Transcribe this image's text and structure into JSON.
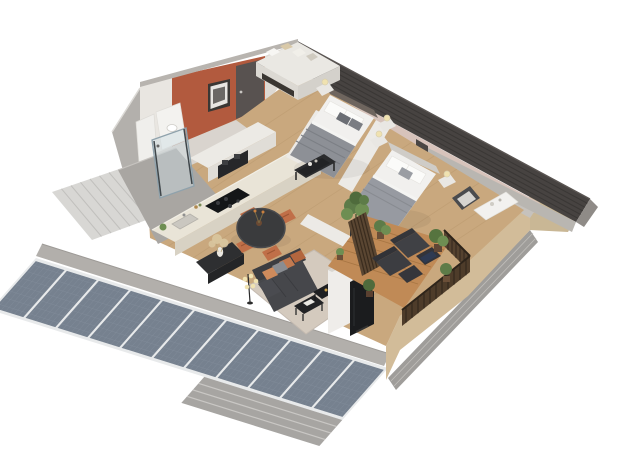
{
  "scene": {
    "kind": "3d-isometric-cutaway-floorplan-render",
    "description": "Attic apartment cutaway floor plan with rooftop solar array, two bedrooms, open kitchen-living-dining room, bathroom, walk-in closet and wood balcony",
    "background": "#ffffff"
  },
  "palette": {
    "bg": "#ffffff",
    "roof_shingle": "#474341",
    "roof_fascia": "#b9b6b1",
    "roof_endcap": "#8f8b87",
    "wall_pink": "#d7c3bb",
    "wall_cap": "#c6c2bd",
    "metal_roof": "#d8d7d4",
    "plate_grey": "#b2afab",
    "slope_grey": "#a9a6a2",
    "outer_slope": "#b3b0ac",
    "solar_panel": "#76818f",
    "solar_frame": "#e8eaeb",
    "eave_grey": "#a7a5a2",
    "eave_grey_2": "#9f9d9a",
    "exterior_beige": "#d2bc99",
    "corner_beige": "#c9b795",
    "wall_terracotta": "#b25a3e",
    "wall_white": "#e9e6e1",
    "wall_grey_right": "#ddd9d3",
    "door_brown": "#585250",
    "floor_wood": "#c9a87e",
    "floor_bath": "#d9d4ce",
    "counter_cream": "#e9e4d7",
    "counter_front": "#d8d2c4",
    "hob_black": "#141618",
    "cabinet_white": "#eceae5",
    "appliance_black": "#26272a",
    "closet_white": "#eae8e3",
    "partition_white": "#eceae6",
    "mattress_white": "#f1f0ee",
    "blanket_grey_1": "#8d9096",
    "blanket_grey_2": "#979aa1",
    "headboard_dark": "#6e655e",
    "headboard_light": "#cfccc7",
    "nightstand_white": "#e9e7e3",
    "lamp_glow": "#f0e2b0",
    "rug_beige": "#d4cabe",
    "sofa_charcoal": "#46474b",
    "sofa_back": "#3c3d41",
    "pillow_orange_1": "#c27a50",
    "pillow_orange_2": "#b3663e",
    "pillow_orange_3": "#cf8b5c",
    "pillow_grey": "#8a8d92",
    "table_black": "#3a3b3d",
    "chair_terracotta": "#c06f48",
    "sideboard_black": "#2e2f31",
    "coffee_table_black": "#222325",
    "tv_black": "#1b1c1e",
    "tv_wall_white": "#efedea",
    "deck_wood": "#c08a56",
    "railing_wood": "#55422f",
    "railing_wood_2": "#4e3c2a",
    "slat_wall": "#5a4632",
    "plant_green_1": "#5d7b48",
    "plant_green_2": "#6e8e52",
    "plant_green_3": "#4f6b3c",
    "pot_brown": "#6b4f38",
    "pampas": "#d9c7a0"
  },
  "roof": {
    "solar_panel_count": 11,
    "dark_shingle_row_lines": 5,
    "metal_rib_lines": 7,
    "eave_row_lines": 3
  },
  "legend": {
    "rooms": [
      "entry-hall",
      "bathroom",
      "kitchen",
      "living-dining-room",
      "bedroom-1",
      "bedroom-2",
      "walk-in-closet",
      "balcony-terrace"
    ],
    "furniture": [
      "entry-door",
      "wall-art",
      "shower",
      "vanity",
      "kitchen-counter",
      "induction-hob",
      "sink",
      "appliance-cabinet",
      "dining-table",
      "dining-chairs",
      "sideboard",
      "sofa",
      "coffee-tables",
      "floor-lamp",
      "tv",
      "double-bed-1",
      "double-bed-2",
      "nightstands",
      "console-table",
      "desk",
      "desk-chair",
      "lounge-chairs",
      "ottomans",
      "potted-plants",
      "area-rug"
    ]
  }
}
